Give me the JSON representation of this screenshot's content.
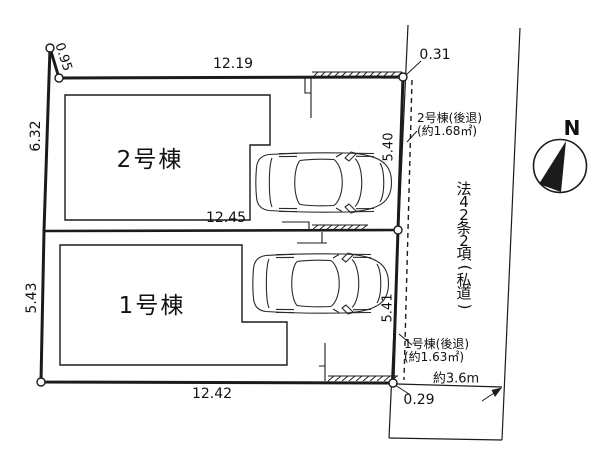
{
  "diagram": {
    "dimensions": {
      "edge_top_left": "0.95",
      "edge_top": "12.19",
      "edge_left_upper": "6.32",
      "edge_middle": "12.45",
      "edge_left_lower": "5.43",
      "edge_bottom": "12.42",
      "edge_right_upper": "5.40",
      "edge_right_lower": "5.41",
      "offset_top_right": "0.31",
      "offset_bottom_right": "0.29"
    },
    "buildings": [
      {
        "label": "1号棟",
        "setback_line1": "1号棟(後退)",
        "setback_line2": "(約1.63㎡)"
      },
      {
        "label": "2号棟",
        "setback_line1": "2号棟(後退)",
        "setback_line2": "(約1.68㎡)"
      }
    ],
    "road": {
      "label": "法42条2項(私道)",
      "width": "約3.6m"
    },
    "compass": {
      "north": "N"
    },
    "colors": {
      "ink": "#1b1b1b",
      "background": "#ffffff"
    }
  }
}
